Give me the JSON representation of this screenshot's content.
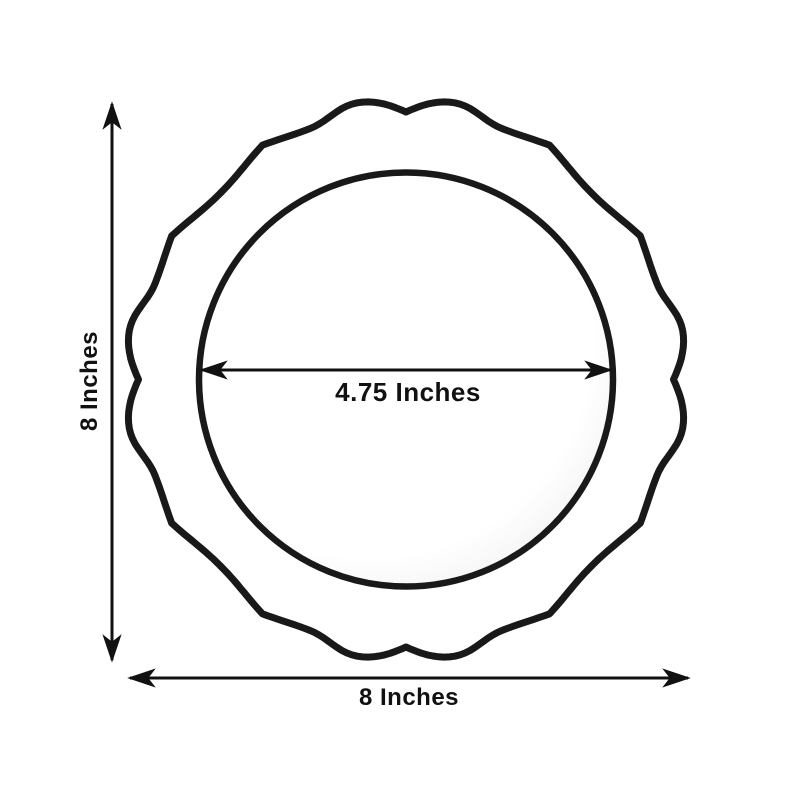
{
  "diagram": {
    "title": "plate-dimension-diagram",
    "height_label": "8 Inches",
    "width_label": "8 Inches",
    "inner_diameter_label": "4.75 Inches"
  },
  "colors": {
    "line": "#191919",
    "dimension": "#111111",
    "background": "#ffffff"
  }
}
